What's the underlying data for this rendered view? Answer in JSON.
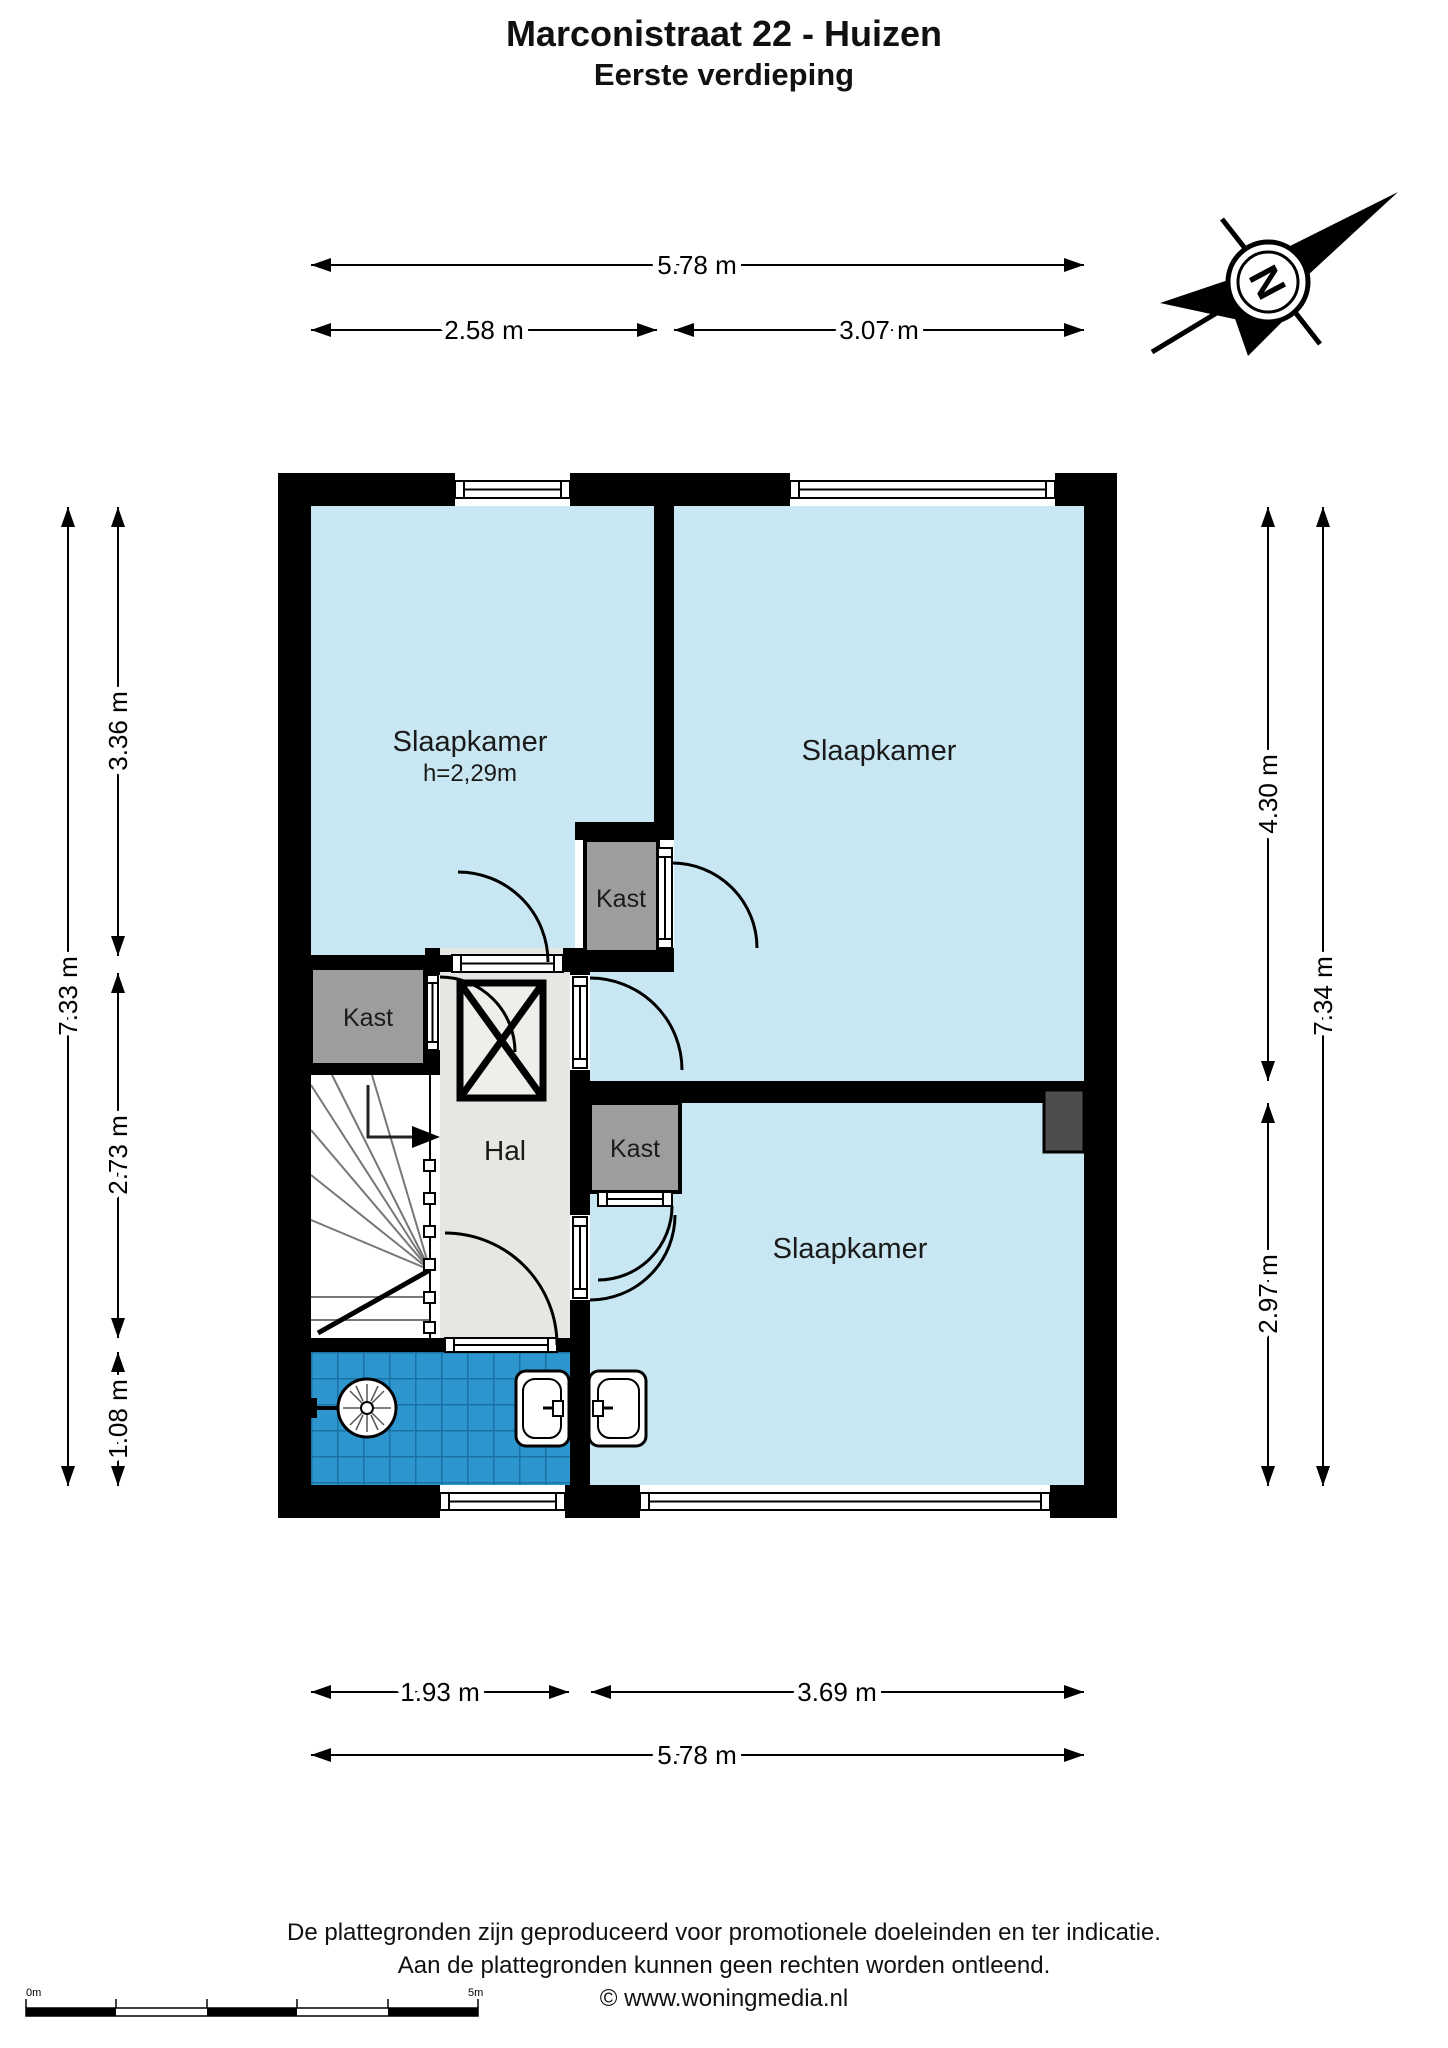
{
  "title": {
    "line1": "Marconistraat 22 - Huizen",
    "line2": "Eerste verdieping"
  },
  "compass": {
    "north_letter": "N"
  },
  "rooms": {
    "bedroom1": {
      "label": "Slaapkamer",
      "height_note": "h=2,29m"
    },
    "bedroom2": {
      "label": "Slaapkamer"
    },
    "bedroom3": {
      "label": "Slaapkamer"
    },
    "hall": {
      "label": "Hal"
    },
    "closet_left": {
      "label": "Kast"
    },
    "closet_middle": {
      "label": "Kast"
    },
    "closet_bottom": {
      "label": "Kast"
    }
  },
  "dimensions": {
    "top_total": "5.78 m",
    "top_left": "2.58 m",
    "top_right": "3.07 m",
    "left_total": "7.33 m",
    "left_top": "3.36 m",
    "left_middle": "2.73 m",
    "left_bottom": "1.08 m",
    "right_top": "4.30 m",
    "right_bottom": "2.97 m",
    "right_total": "7.34 m",
    "bottom_left": "1.93 m",
    "bottom_right": "3.69 m",
    "bottom_total": "5.78 m"
  },
  "scalebar": {
    "start": "0m",
    "end": "5m"
  },
  "footer": {
    "line1": "De plattegronden zijn geproduceerd voor promotionele doeleinden en ter indicatie.",
    "line2": "Aan de plattegronden kunnen geen rechten worden ontleend.",
    "line3": "© www.woningmedia.nl"
  },
  "colors": {
    "wall": "#000000",
    "room_fill": "#c8e7f2",
    "hall_fill": "#e7e6e2",
    "closet_fill": "#9d9d9d",
    "tile_fill": "#2e96ce",
    "tile_grout": "#1a72a4",
    "niche_fill": "#4d4d4d"
  }
}
